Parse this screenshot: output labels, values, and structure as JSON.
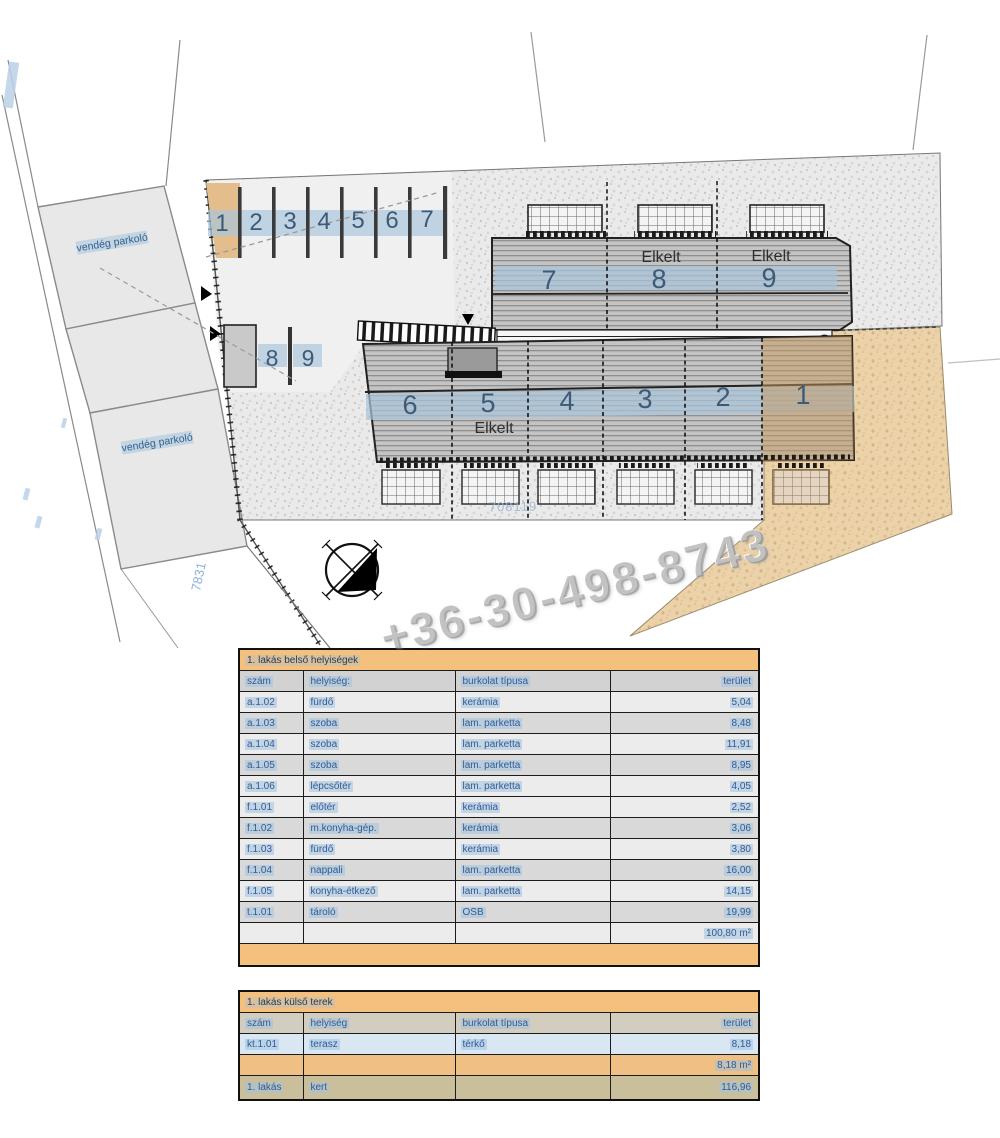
{
  "watermark": {
    "phone": "+36-30-498-8743"
  },
  "site_plan": {
    "guest_parking_label": "vendég parkoló",
    "parcel_number_site": "708119",
    "parcel_number_road": "7831",
    "sold_label": "Elkelt",
    "parking_row": [
      "1",
      "2",
      "3",
      "4",
      "5",
      "6",
      "7"
    ],
    "parking_side": [
      "8",
      "9"
    ],
    "upper_units": [
      "7",
      "8",
      "9"
    ],
    "lower_units": [
      "6",
      "5",
      "4",
      "3",
      "2",
      "1"
    ]
  },
  "tables": [
    {
      "title": "1. lakás belső helyiségek",
      "columns": [
        "szám",
        "helyiség:",
        "burkolat típusa",
        "terület"
      ],
      "rows": [
        [
          "a.1.02",
          "fürdő",
          "kerámia",
          "5,04"
        ],
        [
          "a.1.03",
          "szoba",
          "lam. parketta",
          "8,48"
        ],
        [
          "a.1.04",
          "szoba",
          "lam. parketta",
          "11,91"
        ],
        [
          "a.1.05",
          "szoba",
          "lam. parketta",
          "8,95"
        ],
        [
          "a.1.06",
          "lépcsőtér",
          "lam. parketta",
          "4,05"
        ],
        [
          "f.1.01",
          "előtér",
          "kerámia",
          "2,52"
        ],
        [
          "f.1.02",
          "m.konyha-gép.",
          "kerámia",
          "3,06"
        ],
        [
          "f.1.03",
          "fürdő",
          "kerámia",
          "3,80"
        ],
        [
          "f.1.04",
          "nappali",
          "lam. parketta",
          "16,00"
        ],
        [
          "f.1.05",
          "konyha-étkező",
          "lam. parketta",
          "14,15"
        ],
        [
          "t.1.01",
          "tároló",
          "OSB",
          "19,99"
        ],
        [
          "",
          "",
          "",
          "100,80 m²"
        ]
      ]
    },
    {
      "title": "1. lakás külső terek",
      "columns": [
        "szám",
        "helyiség",
        "burkolat típusa",
        "terület"
      ],
      "rows": [
        [
          "kt.1.01",
          "terasz",
          "térkő",
          "8,18"
        ],
        [
          "",
          "",
          "",
          "8,18 m²"
        ],
        [
          "1. lakás",
          "kert",
          "",
          "116,96"
        ]
      ]
    }
  ],
  "colors": {
    "table_header_orange": "#f4c07e",
    "table_text_blue": "#2f5d96",
    "highlight_blue": "#aac6dd",
    "highlight_tan": "#e3bd8c",
    "roof_grey": "#c4c4c4"
  }
}
